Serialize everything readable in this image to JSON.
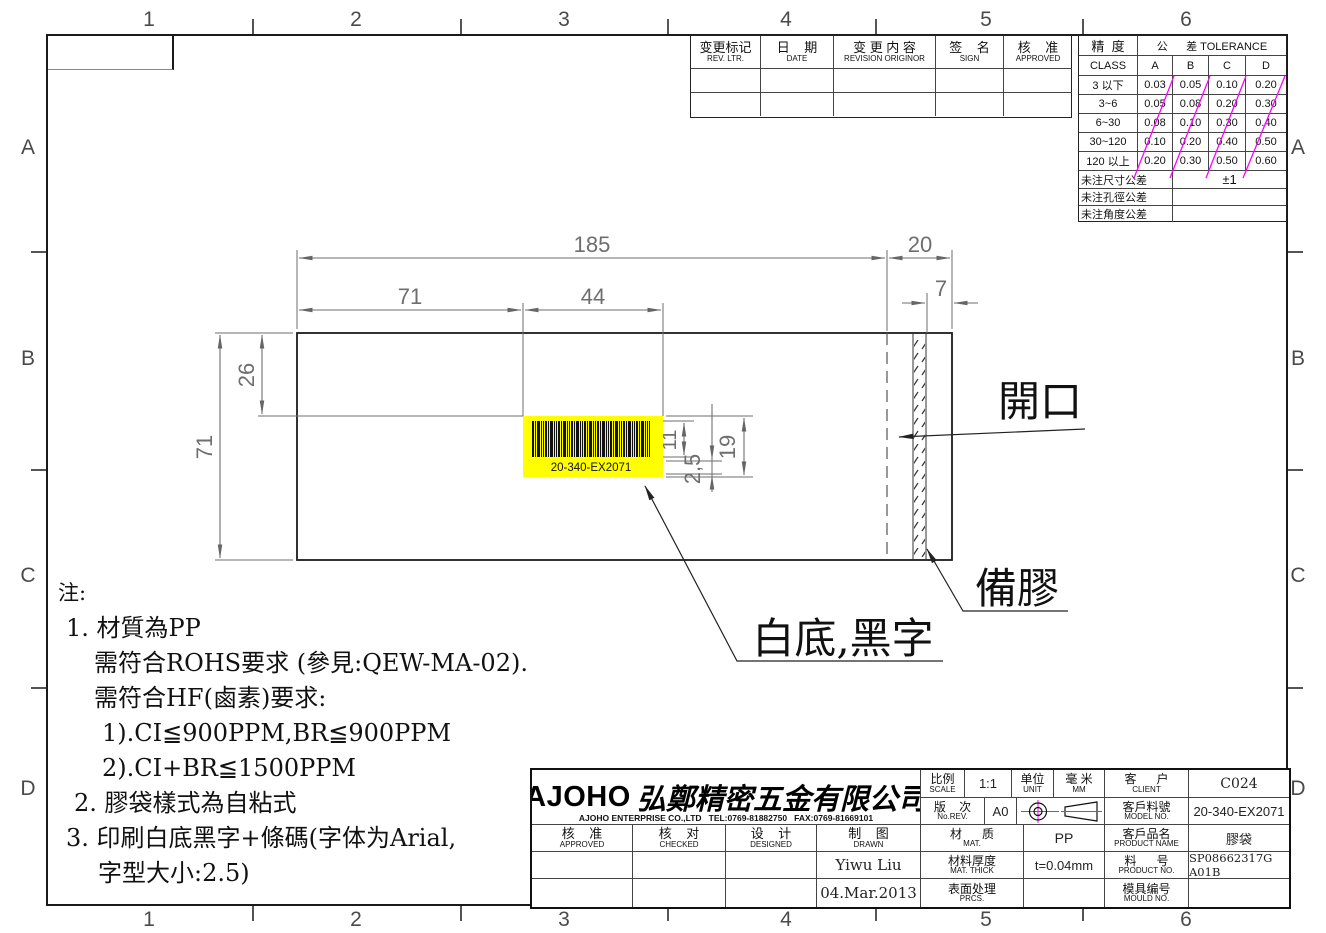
{
  "colors": {
    "magenta": "#ff00ff",
    "yellow": "#ffff00"
  },
  "zones": {
    "cols": [
      "1",
      "2",
      "3",
      "4",
      "5",
      "6"
    ],
    "rows": [
      "A",
      "B",
      "C",
      "D"
    ]
  },
  "revision_table": {
    "headers": [
      {
        "cn": "变更标记",
        "en": "REV. LTR."
      },
      {
        "cn": "日    期",
        "en": "DATE"
      },
      {
        "cn": "变 更 内 容",
        "en": "REVISION ORIGINOR"
      },
      {
        "cn": "签    名",
        "en": "SIGN"
      },
      {
        "cn": "核    准",
        "en": "APPROVED"
      }
    ]
  },
  "tolerance_table": {
    "class_cn": "精  度",
    "class_en": "CLASS",
    "tol_label": "公      差 TOLERANCE",
    "cols": [
      "A",
      "B",
      "C",
      "D"
    ],
    "rows": [
      [
        "3 以下",
        "0.03",
        "0.05",
        "0.10",
        "0.20"
      ],
      [
        "3~6",
        "0.05",
        "0.08",
        "0.20",
        "0.30"
      ],
      [
        "6~30",
        "0.08",
        "0.10",
        "0.30",
        "0.40"
      ],
      [
        "30~120",
        "0.10",
        "0.20",
        "0.40",
        "0.50"
      ],
      [
        "120 以上",
        "0.20",
        "0.30",
        "0.50",
        "0.60"
      ]
    ],
    "footer": [
      {
        "label": "未注尺寸公差",
        "value": "±1"
      },
      {
        "label": "未注孔徑公差",
        "value": ""
      },
      {
        "label": "未注角度公差",
        "value": ""
      }
    ]
  },
  "drawing": {
    "dims": {
      "width_total": "185",
      "flap": "20",
      "left_seg": "71",
      "label_w": "44",
      "glue_w": "7",
      "height": "71",
      "label_top_offset": "26",
      "bars_h": "11",
      "text_h": "2,5",
      "label_h": "19"
    },
    "barcode_text": "20-340-EX2071",
    "labels": {
      "opening": "開口",
      "adhesive": "備膠",
      "print": "白底,黑字"
    }
  },
  "notes": {
    "lines": [
      "注:",
      "1. 材質為PP",
      "需符合ROHS要求 (參見:QEW-MA-02).",
      "需符合HF(鹵素)要求:",
      "1).CI≦900PPM,BR≦900PPM",
      "2).CI+BR≦1500PPM",
      "2. 膠袋樣式為自粘式",
      "3. 印刷白底黑字+條碼(字体为Arial,",
      "字型大小:2.5)"
    ]
  },
  "title_block": {
    "logo": "AJOHO",
    "company_cn": "弘鄭精密五金有限公司",
    "company_en": "AJOHO ENTERPRISE CO.,LTD   TEL:0769-81882750   FAX:0769-81669101",
    "approved": {
      "cn": "核    准",
      "en": "APPROVED"
    },
    "checked": {
      "cn": "核    对",
      "en": "CHECKED"
    },
    "designed": {
      "cn": "设    计",
      "en": "DESIGNED"
    },
    "drawn": {
      "cn": "制    图",
      "en": "DRAWN",
      "name": "Yiwu Liu",
      "date": "04.Mar.2013"
    },
    "scale": {
      "cn": "比例",
      "en": "SCALE",
      "value": "1:1"
    },
    "unit": {
      "cn": "单位",
      "en": "UNIT",
      "value_cn": "毫 米",
      "value_en": "MM"
    },
    "client": {
      "cn": "客      户",
      "en": "CLIENT",
      "value": "C024"
    },
    "rev": {
      "cn": "版    次",
      "en": "No.REV.",
      "value": "A0"
    },
    "model": {
      "cn": "客戶料號",
      "en": "MODEL NO.",
      "value": "20-340-EX2071"
    },
    "material": {
      "cn": "材      质",
      "en": "MAT.",
      "value": "PP"
    },
    "product_name": {
      "cn": "客戶品名",
      "en": "PRODUCT NAME",
      "value": "膠袋"
    },
    "mat_thick": {
      "cn": "材料厚度",
      "en": "MAT. THICK",
      "value": "t=0.04mm"
    },
    "product_no": {
      "cn": "料      号",
      "en": "PRODUCT NO.",
      "value": "SP08662317G A01B"
    },
    "prcs": {
      "cn": "表面处理",
      "en": "PRCS.",
      "value": ""
    },
    "mould": {
      "cn": "模具编号",
      "en": "MOULD NO.",
      "value": ""
    }
  }
}
